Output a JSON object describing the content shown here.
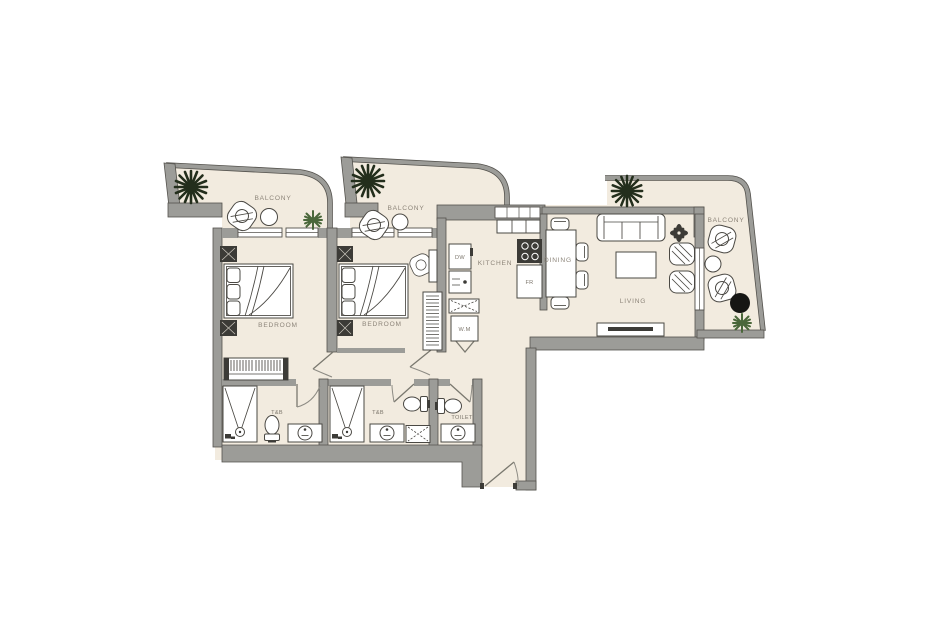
{
  "floor_plan": {
    "labels": {
      "balcony_left": "BALCONY",
      "balcony_middle": "BALCONY",
      "balcony_right": "BALCONY",
      "bedroom_left": "BEDROOM",
      "bedroom_middle": "BEDROOM",
      "kitchen": "KITCHEN",
      "dining": "DINING",
      "living": "LIVING",
      "bath_left": "T&B",
      "bath_middle": "T&B",
      "toilet": "TOILET",
      "dishwasher": "DW",
      "fridge": "FR",
      "washing_machine": "W.M"
    },
    "colors": {
      "background": "#ffffff",
      "floor": "#f2ebdf",
      "wall": "#9c9c98",
      "wall_edge": "#54524d",
      "furniture_line": "#4a4843",
      "label_text": "#8d857a",
      "tree_dark": "#232e1c",
      "bush_green": "#4a673a",
      "accent_black": "#161614"
    }
  }
}
